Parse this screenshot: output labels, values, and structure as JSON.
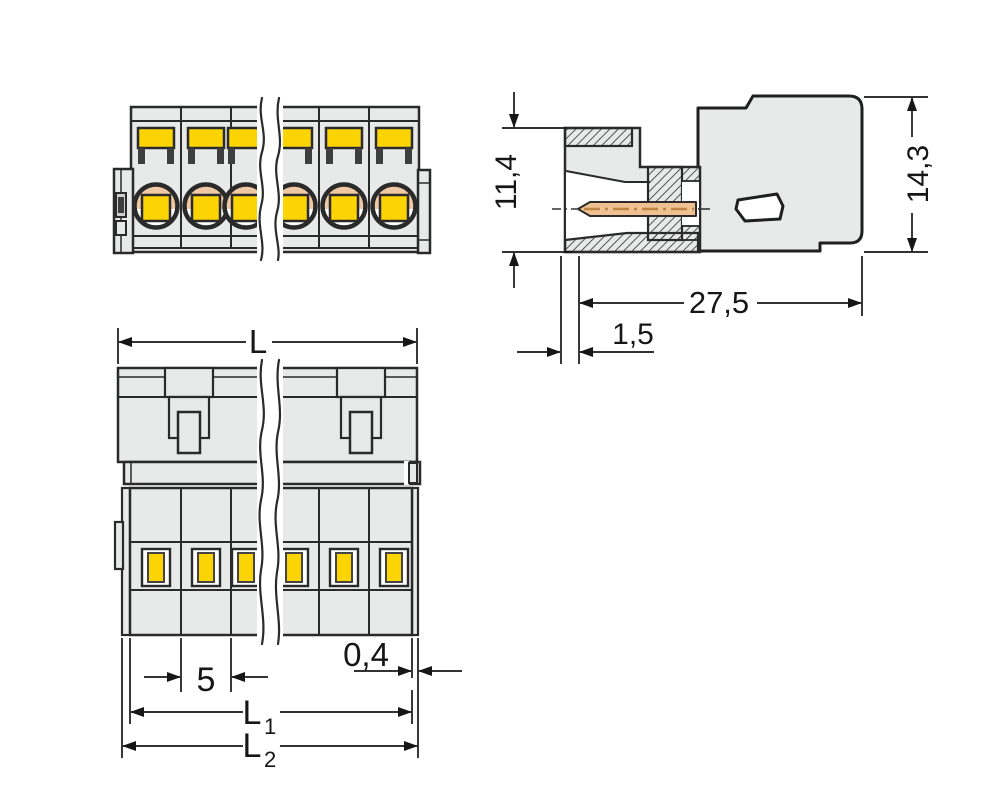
{
  "drawing_title": "Male connector dimensional drawing",
  "dimensions": {
    "plug_height": "11,4",
    "overall_height": "14,3",
    "overall_depth": "27,5",
    "pin_recess": "1,5",
    "overall_length": "L",
    "pole_pitch": "5",
    "end_wall": "0,4",
    "l1": {
      "base": "L",
      "sub": "1"
    },
    "l2": {
      "base": "L",
      "sub": "2"
    }
  },
  "colors": {
    "body": "#e8e9e9",
    "yellow": "#fcd404",
    "peach": "#efc9a3",
    "pin": "#eec092",
    "line": "#2a2a2a",
    "dim": "#161616"
  }
}
